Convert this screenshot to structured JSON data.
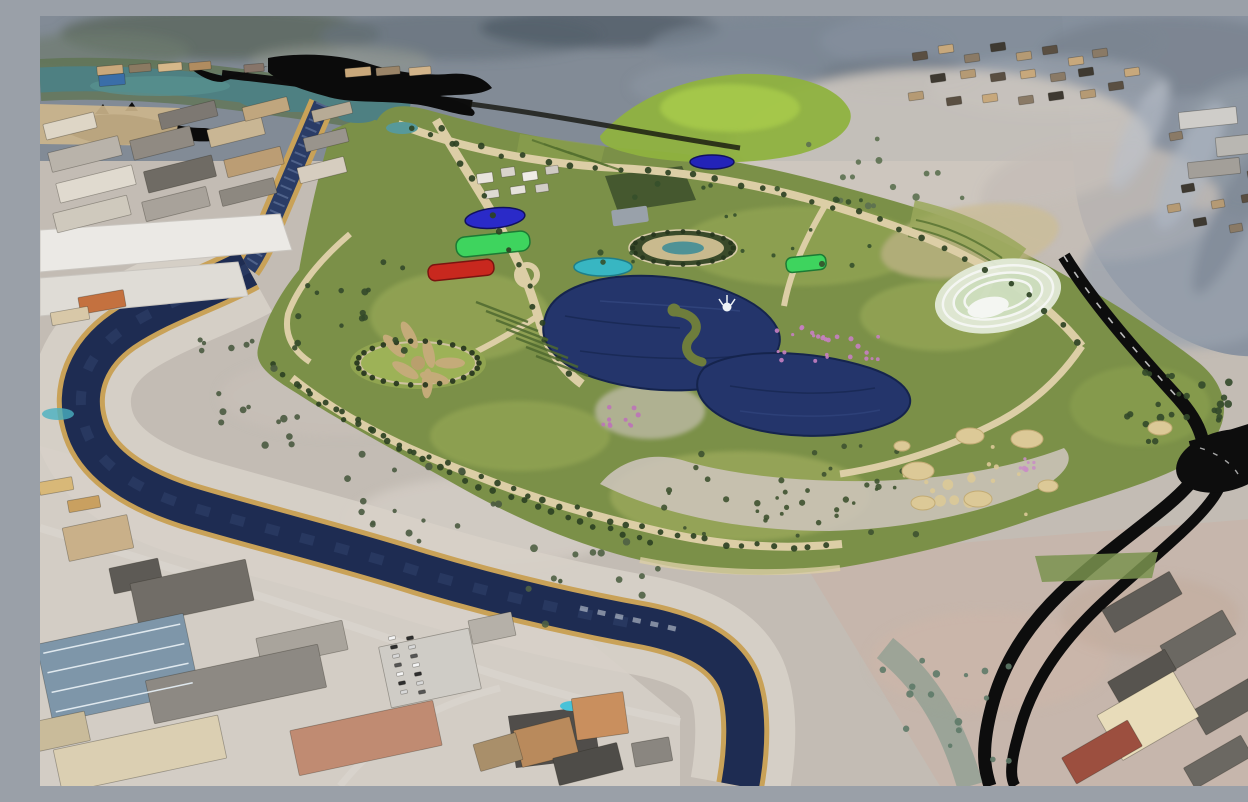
{
  "image": {
    "type": "3d-aerial-render",
    "subject": "Aerial 3D visualization of a large riverside urban park masterplan surrounded by industrial districts, a hillside village and desert mountains",
    "width_px": 1248,
    "height_px": 770
  },
  "palette": {
    "terrain_base": "#c3bcb4",
    "city_ground_light": "#d3cdc5",
    "ground_pink": "#c8b3a7",
    "hills_gray": "#7e8894",
    "hills_dark": "#59646e",
    "hills_light": "#aeb4bd",
    "river_teal": "#4e8082",
    "river_navy": "#1e2c52",
    "canal_blue": "#2a3c66",
    "bank_gold": "#c9a258",
    "floodplain_pale": "#d7d0c8",
    "park_green": "#7b9048",
    "lawn_light": "#9aaa58",
    "tree_dark": "#2d4223",
    "path_tan": "#dccea6",
    "plaza_pale": "#cbc3b8",
    "lake_navy": "#24356b",
    "pond_cyan": "#38b6c2",
    "field_blue": "#2a2ac8",
    "field_green": "#3ed45e",
    "field_red": "#c8281e",
    "amphitheater_white": "#f4f6f2",
    "road_black": "#0d0d0d",
    "roof_white": "#eae8e4",
    "roof_gray": "#716d67",
    "roof_tan": "#c9b089",
    "roof_terracotta": "#c08b72",
    "roof_orange": "#c98f5e",
    "roof_cream": "#dbcfb2",
    "roof_red": "#9c4f3f",
    "flower_pink": "#c77fc2"
  },
  "scene": {
    "background": {
      "hills": "rocky blue-gray desert mountains across the top and right with pale eroded patches",
      "village_top_right": "scattered flat-roofed hillside village houses",
      "upper_river": "teal river running along the upper left between hills and industrial zone"
    },
    "water": {
      "canal": "dark stepped spillway channel dropping from the teal river toward the park",
      "main_river": "navy river looping around the west and south edge of the park with golden embankments and a pale gravel floodplain",
      "lakes": [
        "main lake with seahorse-shaped green island and white fountain",
        "second elongated lake south-east of the main lake",
        "small cyan pond",
        "small dark-blue pond",
        "two teal entrance ponds at the north-west tip"
      ]
    },
    "park": {
      "features": [
        "blue oval sports field",
        "bright green sports field",
        "red sports field",
        "small bright green court on the east side",
        "central oval garden with teal reflecting pool",
        "circular tree-ringed parterre garden with petal beds",
        "white elliptical amphitheater terraces",
        "bright green landscaped hill at the north",
        "orchard and vineyard planting rows",
        "pink flowering gardens",
        "sandy play circles on the south lawns",
        "tree-lined boulevards and promenade"
      ]
    },
    "infrastructure": {
      "highway": "black highway with looping interchange descending along the eastern hills to the bottom of the image",
      "top_roads": "black existing roads and interchange silhouettes at the top left",
      "parking": "small parking lot with cars near the lower-left river bend"
    },
    "districts": [
      "upper-left industrial estate with long white and gray warehouse roofs",
      "lower-left industrial blocks with gray, cream and terracotta roofs and a glazed grid roof",
      "bottom-center compound with orange-roofed buildings and a tiny blue pool",
      "bottom-right district of dark-roofed blocks with one large cream building and a red-roofed hall"
    ]
  }
}
